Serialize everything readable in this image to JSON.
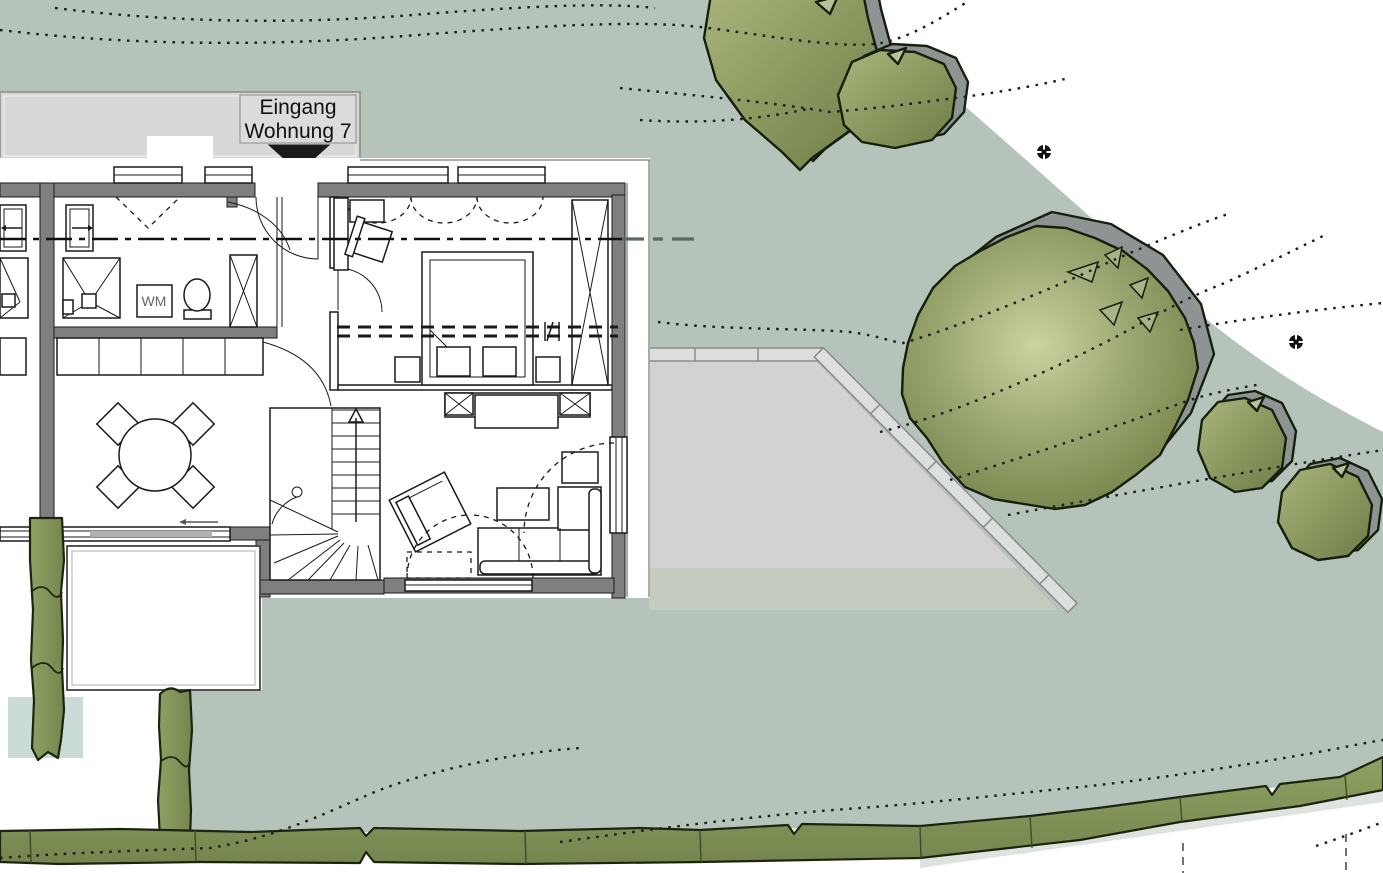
{
  "plan": {
    "title": "Site and floor plan with apartment entrance",
    "labels": {
      "entrance_line1": "Eingang",
      "entrance_line2": "Wohnung 7",
      "washing_machine": "WM"
    },
    "symbols": [
      "entrance-arrow",
      "section-line",
      "stair-up-arrow",
      "survey-marker-1",
      "survey-marker-2"
    ],
    "rooms": [
      "bathroom",
      "hall",
      "bedroom",
      "kitchen",
      "dining",
      "living",
      "stairs"
    ],
    "colors": {
      "sage": "#b5c3ba",
      "walkway": "#d8d8d8",
      "label_box": "#dcdcdc",
      "paved": "#d2d2d2",
      "paved_fade": "#c4ccc1",
      "teal_patch": "#cbdbd6",
      "wall": "#7f7f7f",
      "contour": "#1c1c1c",
      "tree_shadow": "#8e9394",
      "tree_light": "#ccd2a0",
      "tree_mid": "#98a56f",
      "tree_dark": "#76854c",
      "hedge_light": "#8ea263",
      "hedge_dark": "#75854e",
      "hedge_outline": "#1c2410",
      "hedge_shadow": "#dfe3df",
      "text": "#111111",
      "wm_text": "#666666",
      "section_ext": "#5a6a62"
    }
  }
}
